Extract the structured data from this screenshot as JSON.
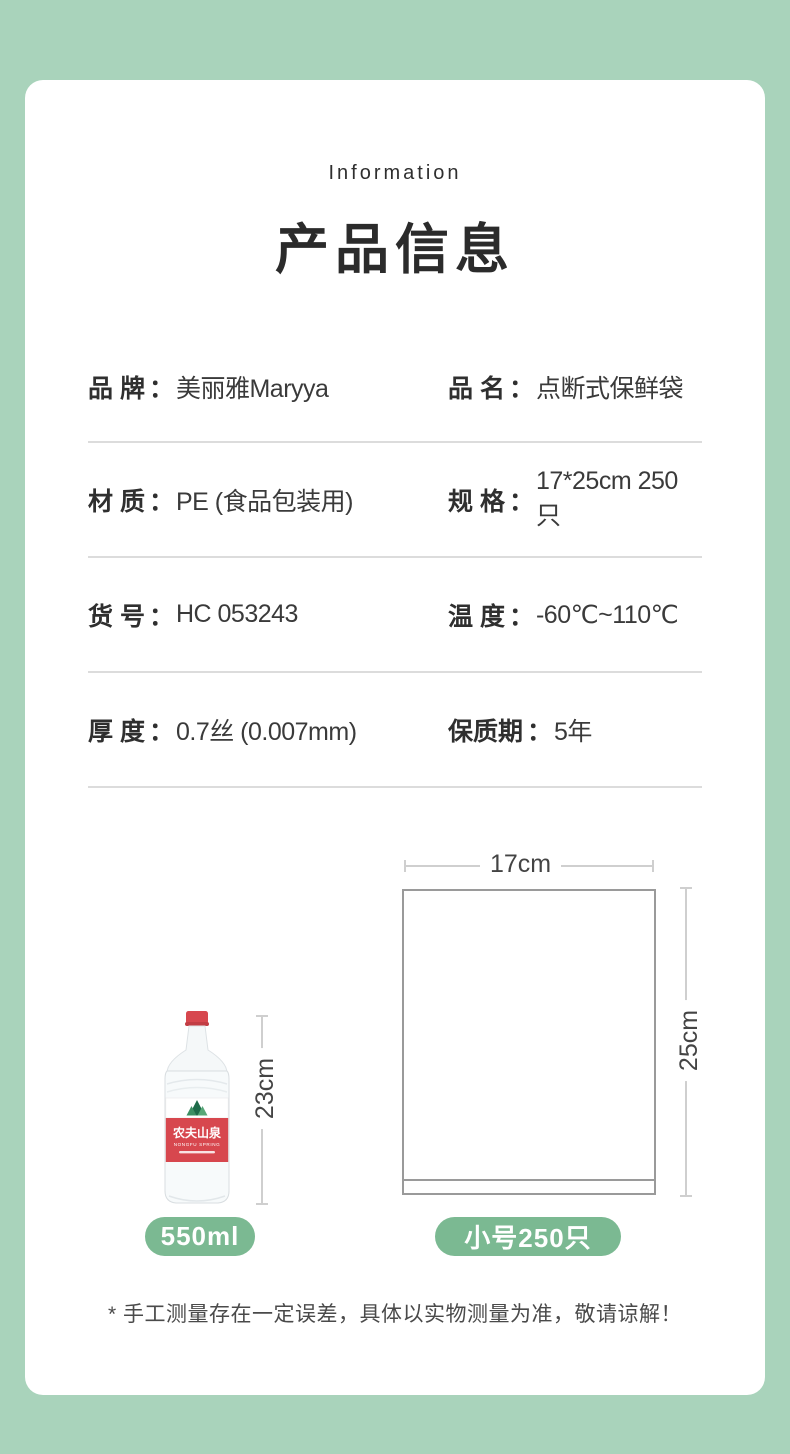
{
  "colors": {
    "background_green": "#a9d3bb",
    "badge_green": "#7bb992",
    "bottle_red": "#d7474e",
    "line_gray": "#cfcfcf",
    "bag_outline_gray": "#9a9a9a"
  },
  "header": {
    "eyebrow": "Information",
    "title": "产品信息"
  },
  "specs": {
    "separator": "：",
    "rows": [
      {
        "left": {
          "label": "品 牌",
          "value": "美丽雅Maryya"
        },
        "right": {
          "label": "品 名",
          "value": "点断式保鲜袋"
        }
      },
      {
        "left": {
          "label": "材 质",
          "value": "PE (食品包装用)"
        },
        "right": {
          "label": "规 格",
          "value": "17*25cm 250只"
        }
      },
      {
        "left": {
          "label": "货 号",
          "value": "HC 053243"
        },
        "right": {
          "label": "温 度",
          "value": "-60℃~110℃"
        }
      },
      {
        "left": {
          "label": "厚 度",
          "value": "0.7丝 (0.007mm)"
        },
        "right": {
          "label": "保质期",
          "value": "5年"
        }
      }
    ]
  },
  "diagram": {
    "bottle": {
      "brand": "农夫山泉",
      "brand_en": "NONGFU SPRING",
      "height_label": "23cm",
      "badge": "550ml"
    },
    "bag": {
      "width_label": "17cm",
      "height_label": "25cm",
      "badge": "小号250只"
    }
  },
  "footnote": "* 手工测量存在一定误差，具体以实物测量为准，敬请谅解！"
}
